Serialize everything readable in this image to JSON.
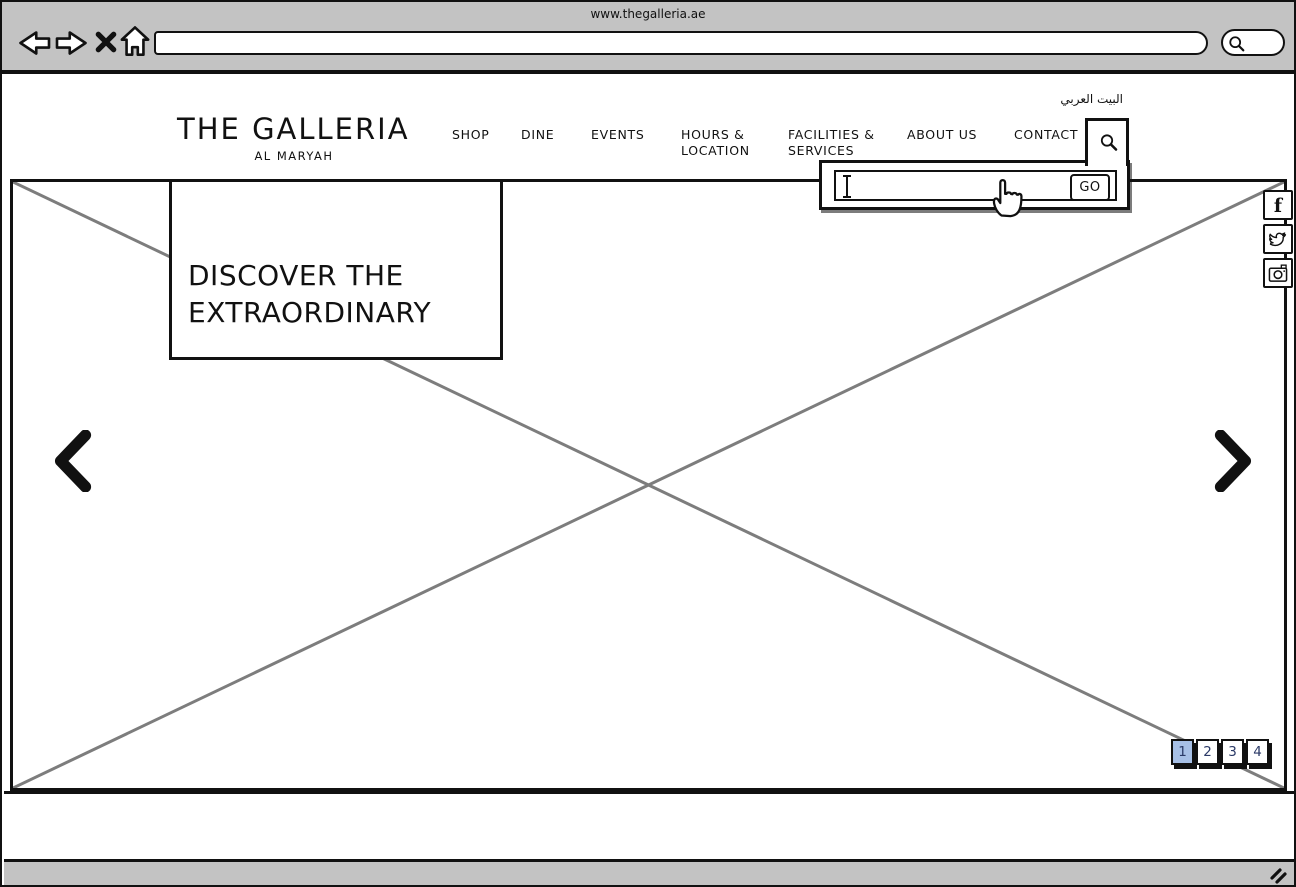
{
  "browser": {
    "title": "www.thegalleria.ae",
    "url_value": "",
    "search_value": ""
  },
  "header": {
    "logo_title": "THE GALLERIA",
    "logo_subtitle": "AL MARYAH",
    "language_link": "البيت العربي",
    "nav_items": [
      {
        "label": "SHOP"
      },
      {
        "label": "DINE"
      },
      {
        "label": "EVENTS"
      },
      {
        "label": "HOURS & LOCATION"
      },
      {
        "label": "FACILITIES & SERVICES"
      },
      {
        "label": "ABOUT US"
      },
      {
        "label": "CONTACT"
      }
    ]
  },
  "search_flyout": {
    "input_value": "",
    "go_label": "GO"
  },
  "hero": {
    "headline": "DISCOVER THE EXTRAORDINARY"
  },
  "carousel": {
    "pages": [
      "1",
      "2",
      "3",
      "4"
    ],
    "active_page": "1"
  },
  "social_icons": [
    {
      "name": "facebook-icon"
    },
    {
      "name": "twitter-icon"
    },
    {
      "name": "instagram-icon"
    }
  ],
  "colors": {
    "chrome_gray": "#c3c3c3",
    "active_page_blue": "#a7c0e6",
    "page_number_navy": "#2b3a67",
    "placeholder_line_gray": "#7d7d7d"
  }
}
